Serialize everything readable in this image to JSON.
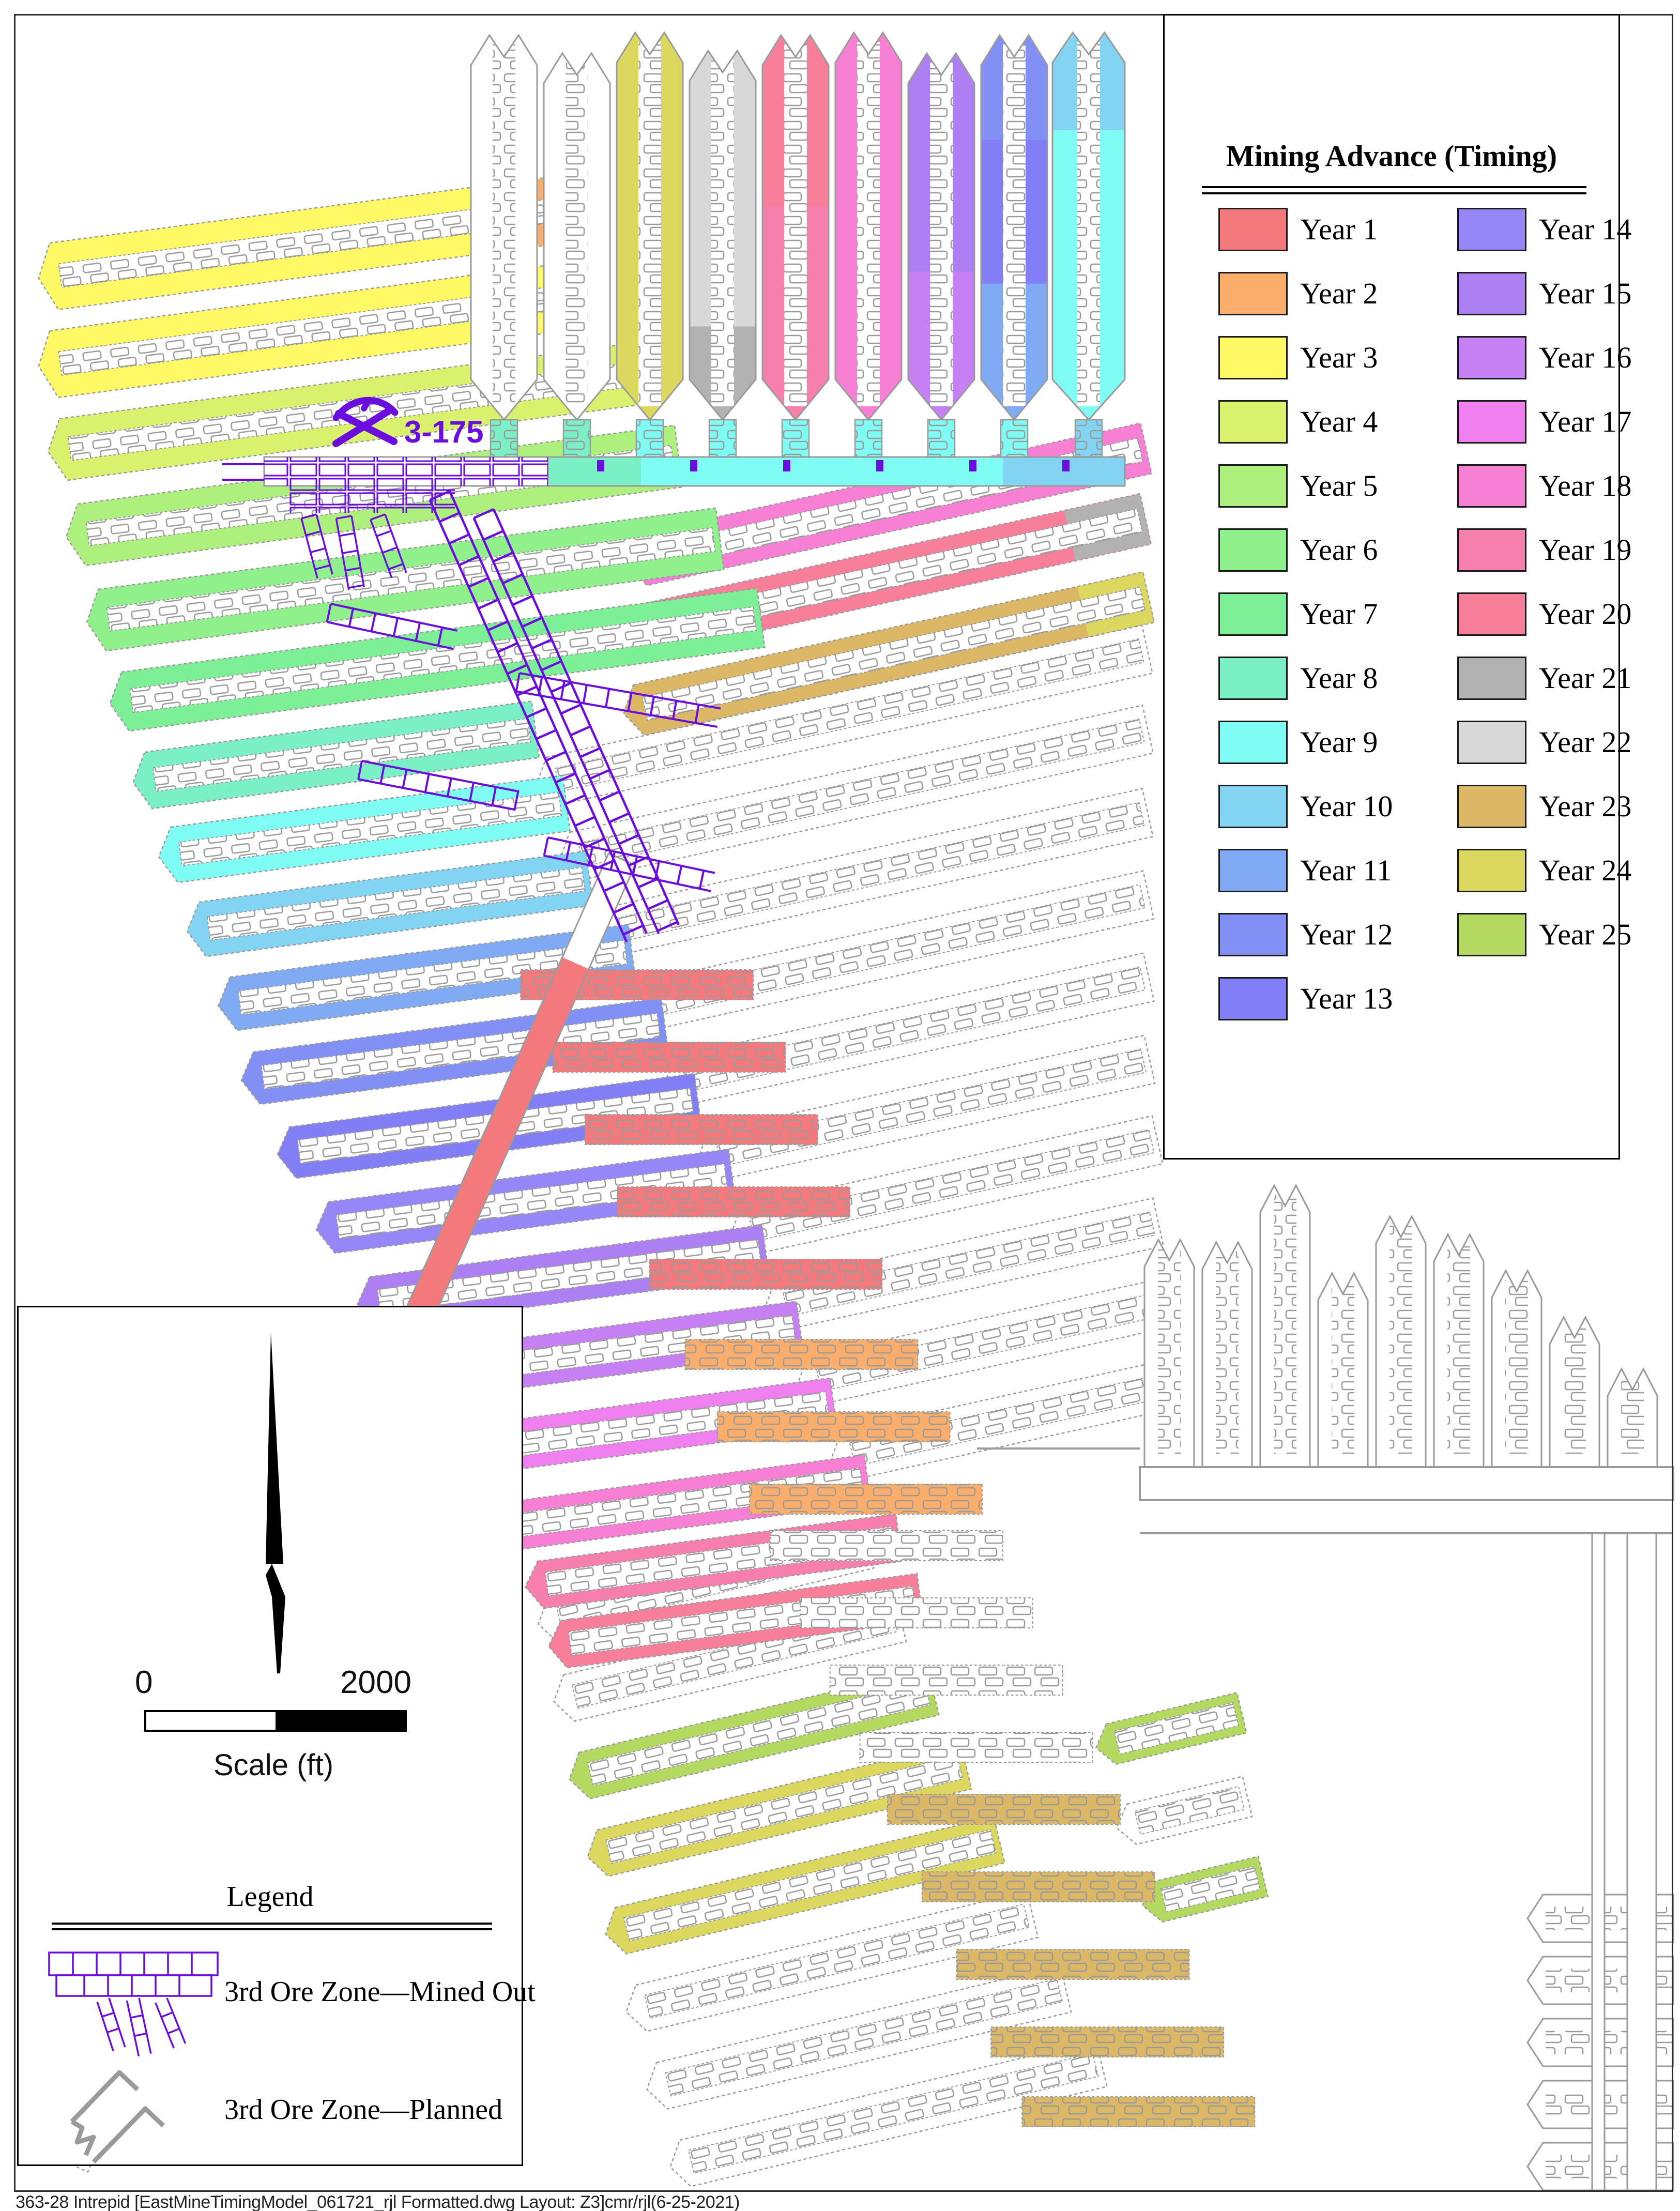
{
  "page": {
    "footer": "363-28 Intrepid [EastMineTimingModel_061721_rjl Formatted.dwg Layout: Z3]cmr/rjl(6-25-2021)"
  },
  "mining_legend": {
    "title": "Mining Advance (Timing)",
    "entries": [
      {
        "label": "Year 1",
        "color": "#f4797d"
      },
      {
        "label": "Year 2",
        "color": "#fbae6b"
      },
      {
        "label": "Year 3",
        "color": "#fff966"
      },
      {
        "label": "Year 4",
        "color": "#d9f16d"
      },
      {
        "label": "Year 5",
        "color": "#adf07e"
      },
      {
        "label": "Year 6",
        "color": "#90f08b"
      },
      {
        "label": "Year 7",
        "color": "#7cef97"
      },
      {
        "label": "Year 8",
        "color": "#7befc6"
      },
      {
        "label": "Year 9",
        "color": "#7ffcf4"
      },
      {
        "label": "Year 10",
        "color": "#82d4f2"
      },
      {
        "label": "Year 11",
        "color": "#80aaf4"
      },
      {
        "label": "Year 12",
        "color": "#8290f6"
      },
      {
        "label": "Year 13",
        "color": "#827ff6"
      },
      {
        "label": "Year 14",
        "color": "#9687f8"
      },
      {
        "label": "Year 15",
        "color": "#ac7ff2"
      },
      {
        "label": "Year 16",
        "color": "#c77ff4"
      },
      {
        "label": "Year 17",
        "color": "#f07ff0"
      },
      {
        "label": "Year 18",
        "color": "#f77fd4"
      },
      {
        "label": "Year 19",
        "color": "#f77fae"
      },
      {
        "label": "Year 20",
        "color": "#f77f99"
      },
      {
        "label": "Year 21",
        "color": "#b2b2b2"
      },
      {
        "label": "Year 22",
        "color": "#d8d8d8"
      },
      {
        "label": "Year 23",
        "color": "#dbb766"
      },
      {
        "label": "Year 24",
        "color": "#dbd75f"
      },
      {
        "label": "Year 25",
        "color": "#b4d961"
      }
    ]
  },
  "map_legend": {
    "title": "Legend",
    "items": [
      {
        "label": "3rd Ore Zone—Mined Out",
        "symbol": "mined-out-workings",
        "color": "#6a0ddd"
      },
      {
        "label": "3rd Ore Zone—Planned",
        "symbol": "planned-outline",
        "color": "#9a9a9a"
      }
    ]
  },
  "scale_bar": {
    "start_label": "0",
    "end_label": "2000",
    "caption": "Scale (ft)"
  },
  "annotations": {
    "shaft_label": "3-175",
    "shaft_symbol": "crossed-picks",
    "color": "#6a0ddd"
  }
}
